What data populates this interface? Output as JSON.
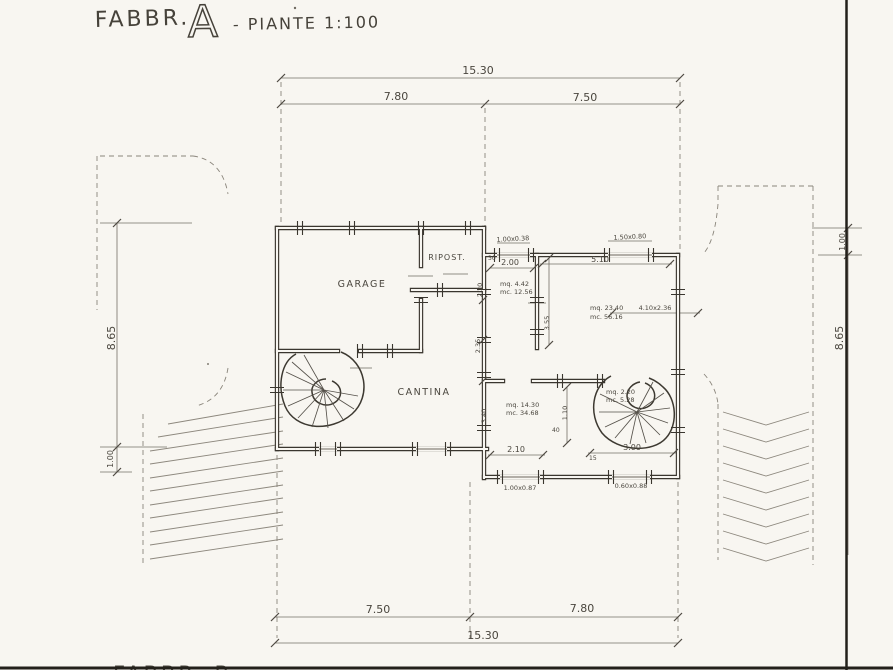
{
  "title": {
    "name": "FABBR.",
    "letter": "A",
    "subtitle": "- PIANTE 1:100"
  },
  "rooms": {
    "garage": "GARAGE",
    "ripostiglio": "RIPOST.",
    "cantina": "CANTINA"
  },
  "dims": {
    "top_total": "15.30",
    "top_left": "7.80",
    "top_right": "7.50",
    "bottom_left": "7.50",
    "bottom_right": "7.80",
    "bottom_total": "15.30",
    "left_main": "8.65",
    "left_small": "1.00",
    "right_small": "1.00",
    "right_main": "8.65"
  },
  "interior": {
    "room_w": "2.00",
    "main_w": "5.10",
    "v1": "2.20",
    "v2": "2.35",
    "v3": "3.40",
    "v4": "3.55",
    "v5": "1.10",
    "d1": "2.10",
    "d2": "3.00",
    "t40": "40",
    "t15": "15",
    "t30": "30"
  },
  "windows": {
    "w1": "1.00x0.38",
    "w2": "1.50x0.80",
    "w3": "1.00x0.87",
    "w4": "0.60x0.88"
  },
  "areas": {
    "small_mq": "mq. 4.42",
    "small_mc": "mc. 12.56",
    "main_mq": "mq. 23.40",
    "main_mc": "mc. 56.16",
    "stair_mq": "mq. 2.20",
    "stair_mc": "mc. 5.28",
    "low_mq": "mq. 14.30",
    "low_mc": "mc. 34.68",
    "ext": "4.10x2.36"
  },
  "footer": {
    "partial": "FABBR. B"
  },
  "colors": {
    "paper": "#f8f6f1",
    "ink": "#3a362f",
    "pencil": "#747066"
  }
}
